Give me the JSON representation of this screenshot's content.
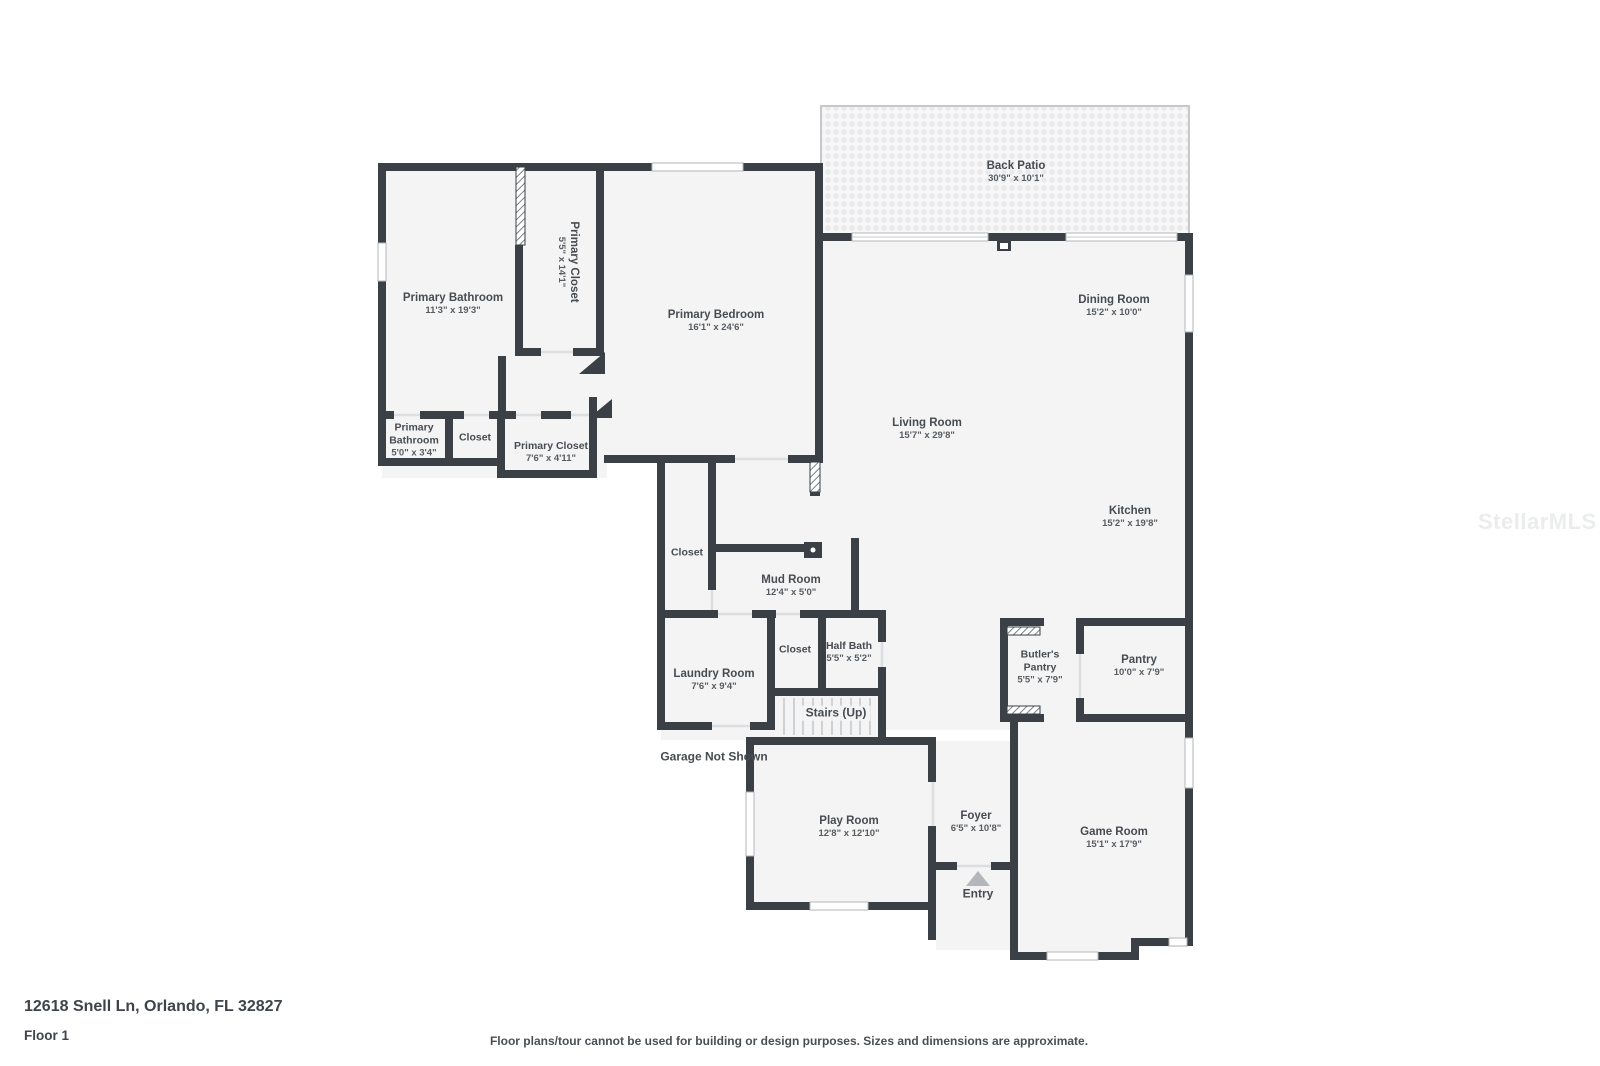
{
  "colors": {
    "wall": "#3a4045",
    "room_fill": "#f4f4f5",
    "patio_dot": "#e9e9ec",
    "label_text": "#474c51",
    "entry_arrow": "#b3b7bb"
  },
  "rooms": {
    "back_patio": {
      "name": "Back Patio",
      "dims": "30'9\" x 10'1\""
    },
    "primary_bathroom": {
      "name": "Primary Bathroom",
      "dims": "11'3\" x 19'3\""
    },
    "primary_closet": {
      "name": "Primary Closet",
      "dims": "5'5\" x 14'1\""
    },
    "primary_bedroom": {
      "name": "Primary Bedroom",
      "dims": "16'1\" x 24'6\""
    },
    "dining_room": {
      "name": "Dining Room",
      "dims": "15'2\" x 10'0\""
    },
    "living_room": {
      "name": "Living Room",
      "dims": "15'7\" x 29'8\""
    },
    "kitchen": {
      "name": "Kitchen",
      "dims": "15'2\" x 19'8\""
    },
    "primary_bathroom_2": {
      "name": "Primary Bathroom",
      "dims": "5'0\" x 3'4\""
    },
    "closet_1": {
      "name": "Closet"
    },
    "primary_closet_2": {
      "name": "Primary Closet",
      "dims": "7'6\" x 4'11\""
    },
    "closet_2": {
      "name": "Closet"
    },
    "mud_room": {
      "name": "Mud Room",
      "dims": "12'4\" x 5'0\""
    },
    "closet_3": {
      "name": "Closet"
    },
    "half_bath": {
      "name": "Half Bath",
      "dims": "5'5\" x 5'2\""
    },
    "laundry_room": {
      "name": "Laundry Room",
      "dims": "7'6\" x 9'4\""
    },
    "butlers_pantry": {
      "name": "Butler's Pantry",
      "dims": "5'5\" x 7'9\""
    },
    "pantry": {
      "name": "Pantry",
      "dims": "10'0\" x 7'9\""
    },
    "play_room": {
      "name": "Play Room",
      "dims": "12'8\" x 12'10\""
    },
    "foyer": {
      "name": "Foyer",
      "dims": "6'5\" x 10'8\""
    },
    "game_room": {
      "name": "Game Room",
      "dims": "15'1\" x 17'9\""
    }
  },
  "annotations": {
    "stairs": "Stairs (Up)",
    "garage_note": "Garage Not Shown",
    "entry": "Entry"
  },
  "footer": {
    "address": "12618 Snell Ln, Orlando, FL 32827",
    "floor_label": "Floor 1",
    "disclaimer": "Floor plans/tour cannot be used for building or design purposes. Sizes and dimensions are approximate."
  },
  "watermark": "StellarMLS"
}
